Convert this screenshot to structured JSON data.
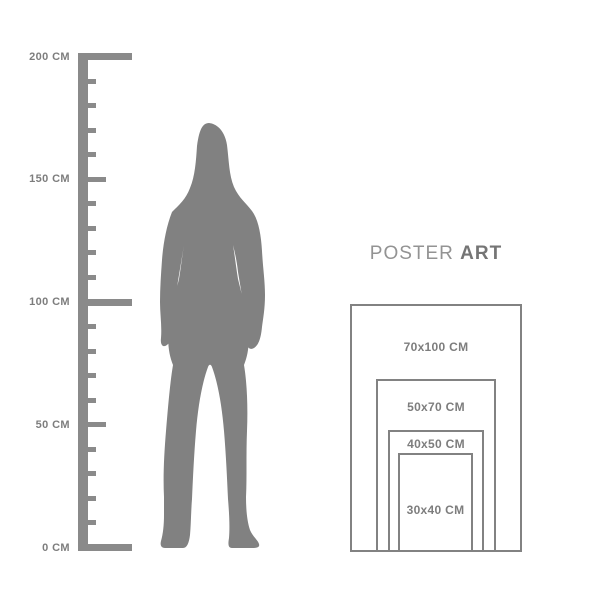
{
  "title": {
    "regular": "POSTER",
    "bold": "ART"
  },
  "ruler": {
    "labels": [
      "200 CM",
      "150 CM",
      "100 CM",
      "50 CM",
      "0 CM"
    ],
    "unit": "CM",
    "max": 200,
    "min": 0,
    "minor_step": 10,
    "major_step": 50
  },
  "figure": {
    "description": "standing woman silhouette"
  },
  "posters": {
    "sizes": [
      {
        "label": "70x100 CM"
      },
      {
        "label": "50x70 CM"
      },
      {
        "label": "40x50 CM"
      },
      {
        "label": "30x40 CM"
      }
    ]
  },
  "colors": {
    "silhouette_gray": "#818181",
    "ruler_gray": "#8a8a8a",
    "text_gray": "#7d7d7d",
    "border_gray": "#828282"
  }
}
